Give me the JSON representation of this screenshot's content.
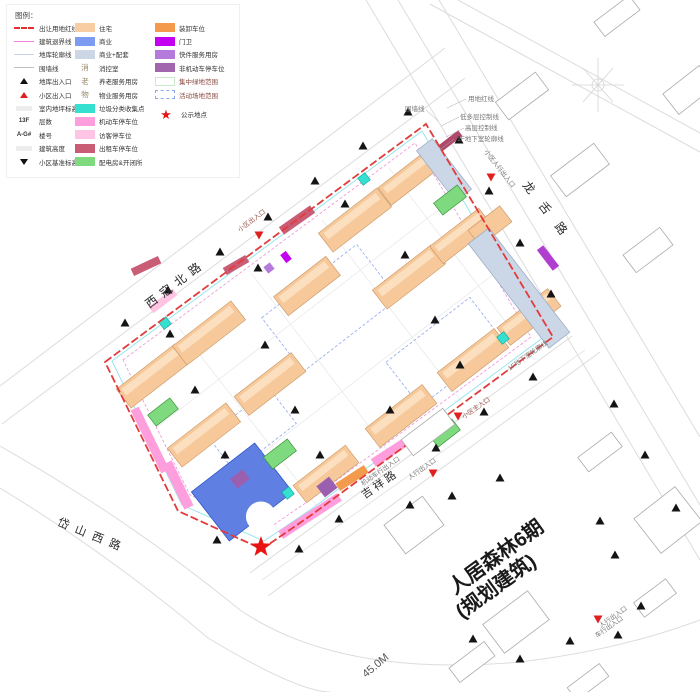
{
  "legend": {
    "title": "图例：",
    "col1": [
      {
        "label": "出让用地红线"
      },
      {
        "label": "建筑退界线"
      },
      {
        "label": "地库轮廓线"
      },
      {
        "label": "围墙线"
      },
      {
        "label": "地库出入口"
      },
      {
        "label": "小区出入口"
      },
      {
        "label": "室内地坪标高"
      },
      {
        "label": "层数",
        "symbol": "13F"
      },
      {
        "label": "楼号",
        "symbol": "A-G#"
      },
      {
        "label": "建筑高度"
      },
      {
        "label": "小区基准标高"
      }
    ],
    "col2": [
      {
        "label": "住宅",
        "color": "#F8CDA3"
      },
      {
        "label": "商业",
        "color": "#7D9BF0"
      },
      {
        "label": "商业+配套",
        "color": "#CCD6E4"
      },
      {
        "label": "消控室",
        "symbol": "消"
      },
      {
        "label": "养老服务用房",
        "symbol": "老"
      },
      {
        "label": "物业服务用房",
        "symbol": "物"
      },
      {
        "label": "垃圾分类收集点",
        "color": "#35E0D0"
      },
      {
        "label": "机动车停车位",
        "color": "#FF9EDD"
      },
      {
        "label": "访客停车位",
        "color": "#FFC4E4"
      },
      {
        "label": "出租车停车位",
        "color": "#C95D75"
      },
      {
        "label": "配电房&开闭所",
        "color": "#7FD97F"
      }
    ],
    "col3": [
      {
        "label": "装卸车位",
        "color": "#F49A4D"
      },
      {
        "label": "门卫",
        "color": "#C400F0"
      },
      {
        "label": "快件服务用房",
        "color": "#B57BDC"
      },
      {
        "label": "非机动车停车位",
        "color": "#A266AE"
      },
      {
        "label": "集中绿地范围",
        "color": "#FFFFFF"
      },
      {
        "label": "活动场地范围",
        "color": "#FFFFFF"
      },
      {
        "label": "公示地点",
        "symbol": "★"
      }
    ]
  },
  "map": {
    "road_names": {
      "xikou": "西寇北路",
      "longshe": "龙舌路",
      "daishan": "岱山西路",
      "jixiang": "吉祥路"
    },
    "district_label": {
      "line1": "人居森林6期",
      "line2": "(规划建筑)"
    },
    "scale_label": "45.0M",
    "callouts": {
      "boundary": "用地红线",
      "low_rise": "低多层控制线",
      "high_rise": "高层控制线",
      "basement": "-1F地下室轮廓线",
      "wall": "围墙线",
      "ped_entry_ne": "小区人行出入口",
      "entry_nw": "小区出入口",
      "main_entry": "小区主入口",
      "vehicle_entry": "机动车行出入口",
      "ped_entry_s": "人行出入口",
      "basement2": "-1F地下室轮廓线",
      "ped_entry_br": "人行出入口",
      "car_entry_br": "车行出入口"
    }
  },
  "colors": {
    "red_line": "#E23B3B",
    "residential": "#F6C89A",
    "commercial": "#5F7FE3",
    "commercial_support": "#CBD7E7",
    "green_power": "#7FD97F",
    "cyan_waste": "#35E0D0",
    "gate_magenta": "#C400F0",
    "star_red": "#E81414"
  }
}
